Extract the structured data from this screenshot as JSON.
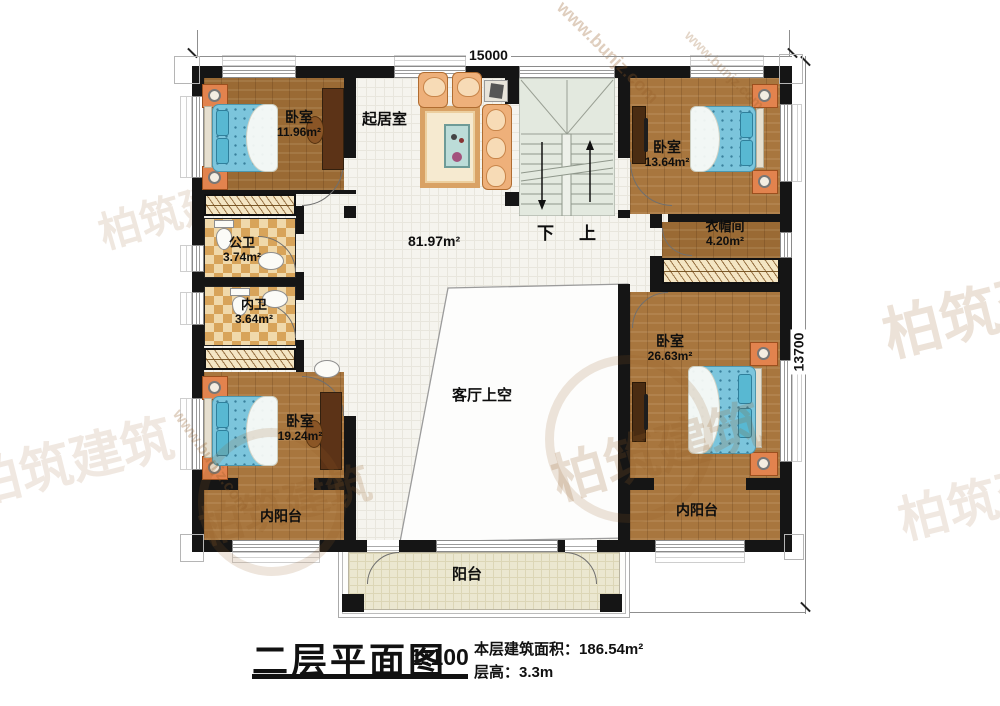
{
  "title_block": {
    "title": "二层平面图",
    "scale": "1:100",
    "area_label": "本层建筑面积：",
    "area_value": "186.54m²",
    "floor_height_label": "层高：",
    "floor_height_value": "3.3m"
  },
  "dimensions": {
    "top": "15000",
    "right": "13700"
  },
  "rooms": {
    "bedroom_tl": {
      "name": "卧室",
      "area": "11.96m²"
    },
    "living": {
      "name": "起居室"
    },
    "hall": {
      "area": "81.97m²"
    },
    "bedroom_tr": {
      "name": "卧室",
      "area": "13.64m²"
    },
    "bath_public": {
      "name": "公卫",
      "area": "3.74m²"
    },
    "bath_inner": {
      "name": "内卫",
      "area": "3.64m²"
    },
    "cloakroom": {
      "name": "衣帽间",
      "area": "4.20m²"
    },
    "bedroom_bl": {
      "name": "卧室",
      "area": "19.24m²"
    },
    "bedroom_r": {
      "name": "卧室",
      "area": "26.63m²"
    },
    "void_over_living": {
      "name": "客厅上空"
    },
    "inner_balcony_left": {
      "name": "内阳台"
    },
    "inner_balcony_right": {
      "name": "内阳台"
    },
    "balcony": {
      "name": "阳台"
    }
  },
  "stairs": {
    "down_label": "下",
    "up_label": "上"
  },
  "watermark": {
    "brand": "柏筑建筑",
    "url": "www.bunjz.com"
  },
  "colors": {
    "wall": "#151515",
    "wood": "#a8763e",
    "tile_accent": "#d8a45a",
    "stair": "#e3e9df",
    "balcony": "#ebe7d0",
    "bed": "#7cc5dc",
    "furniture_orange": "#e2834e"
  }
}
